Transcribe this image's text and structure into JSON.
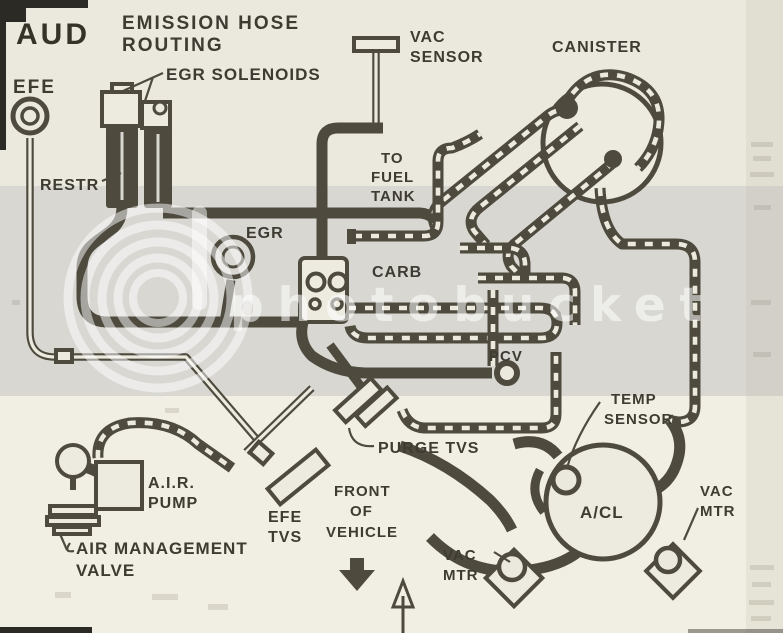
{
  "title": {
    "code": "AUD",
    "heading_line1": "EMISSION HOSE",
    "heading_line2": "ROUTING"
  },
  "labels": {
    "efe": "EFE",
    "egr_solenoids": "EGR SOLENOIDS",
    "restr": "RESTR",
    "vac_sensor": [
      "VAC",
      "SENSOR"
    ],
    "canister": "CANISTER",
    "to_fuel_tank": [
      "TO",
      "FUEL",
      "TANK"
    ],
    "egr": "EGR",
    "carb": "CARB",
    "pcv": "PCV",
    "temp_sensor": [
      "TEMP",
      "SENSOR"
    ],
    "acl": "A/CL",
    "vac_mtr_left": [
      "VAC",
      "MTR"
    ],
    "vac_mtr_right": [
      "VAC",
      "MTR"
    ],
    "purge_tvs": "PURGE TVS",
    "efe_tvs": [
      "EFE",
      "TVS"
    ],
    "front_of_vehicle": [
      "FRONT",
      "OF",
      "VEHICLE"
    ],
    "air_pump": [
      "A.I.R.",
      "PUMP"
    ],
    "air_management_valve": [
      "AIR MANAGEMENT",
      "VALVE"
    ]
  },
  "watermark": {
    "text": "photobucket",
    "logo": "concentric-rings-b-logo",
    "color": "#ffffff"
  },
  "arrows": {
    "front_of_vehicle_arrow": "down",
    "bottom_center_arrow": "up"
  },
  "colors": {
    "ink": "#4e4a3e",
    "label_ink": "#3e3b32",
    "paper_top": "#ebe8dd",
    "paper_bottom": "#f1eee3",
    "watermark_band": "#d8d7d2",
    "edge_strip": "#b8b2a2"
  }
}
